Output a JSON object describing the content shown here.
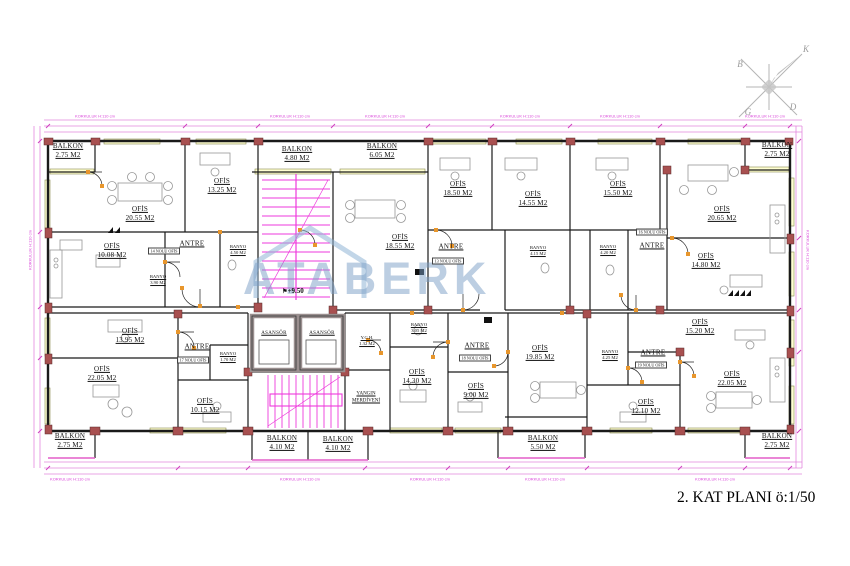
{
  "plan": {
    "title": "2. KAT PLANI ö:1/50",
    "watermark": "ATABERK",
    "elevation": "+9.50",
    "antre_label": "ANTRE",
    "elevator_label": "ASANSÖR",
    "railing_note": "KORKULUK H:110 cm"
  },
  "compass": {
    "north": "K",
    "west": "B",
    "east": "D",
    "south": "G"
  },
  "rooms": [
    {
      "name": "BALKON",
      "area": "2.75 M2"
    },
    {
      "name": "OFİS",
      "area": "20.55 M2"
    },
    {
      "name": "OFİS",
      "area": "13.25 M2"
    },
    {
      "name": "BALKON",
      "area": "4.80 M2"
    },
    {
      "name": "BALKON",
      "area": "6.05 M2"
    },
    {
      "name": "OFİS",
      "area": "18.55 M2"
    },
    {
      "name": "OFİS",
      "area": "18.50 M2"
    },
    {
      "name": "OFİS",
      "area": "14.55 M2"
    },
    {
      "name": "OFİS",
      "area": "15.50 M2"
    },
    {
      "name": "OFİS",
      "area": "20.65 M2"
    },
    {
      "name": "BALKON",
      "area": "2.75 M2"
    },
    {
      "name": "OFİS",
      "area": "10.08 M2"
    },
    {
      "name": "OFİS",
      "area": "14.80 M2"
    },
    {
      "name": "OFİS",
      "area": "13.95 M2"
    },
    {
      "name": "OFİS",
      "area": "22.05 M2"
    },
    {
      "name": "OFİS",
      "area": "10.15 M2"
    },
    {
      "name": "OFİS",
      "area": "14.30 M2"
    },
    {
      "name": "OFİS",
      "area": "9.00 M2"
    },
    {
      "name": "OFİS",
      "area": "19.85 M2"
    },
    {
      "name": "OFİS",
      "area": "15.20 M2"
    },
    {
      "name": "OFİS",
      "area": "12.10 M2"
    },
    {
      "name": "OFİS",
      "area": "22.05 M2"
    },
    {
      "name": "BALKON",
      "area": "2.75 M2"
    },
    {
      "name": "BALKON",
      "area": "4.10 M2"
    },
    {
      "name": "BALKON",
      "area": "4.10 M2"
    },
    {
      "name": "BALKON",
      "area": "5.50 M2"
    },
    {
      "name": "BALKON",
      "area": "2.75 M2"
    }
  ],
  "banyo": [
    {
      "name": "BANYO",
      "area": "3.90 M2"
    },
    {
      "name": "BANYO",
      "area": "4.50 M2"
    },
    {
      "name": "BANYO",
      "area": "4.15 M2"
    },
    {
      "name": "BANYO",
      "area": "4.20 M2"
    },
    {
      "name": "BANYO",
      "area": "1.70 M2"
    },
    {
      "name": "BANYO",
      "area": "3.05 M2"
    },
    {
      "name": "BANYO",
      "area": "4.25 M2"
    }
  ],
  "units": [
    "14 NOLU OFİS",
    "13 NOLU OFİS",
    "16 NOLU OFİS",
    "17 NOLU OFİS",
    "18 NOLU OFİS",
    "19 NOLU OFİS"
  ],
  "core": {
    "ygh_name": "Y.G.H.",
    "ygh_area": "1.32 M2",
    "fire_line1": "YANGIN",
    "fire_line2": "MERDİVENİ"
  },
  "colors": {
    "walls": "#1a1a1a",
    "dimension_lines": "#e388de",
    "dimension_text": "#d944d9",
    "stairs": "#ee3adc",
    "doors": "#e8962c",
    "columns": "#a85050",
    "window_sill": "#ffffd2",
    "watermark": "#7a9ec6",
    "compass": "#b5b5b5"
  }
}
